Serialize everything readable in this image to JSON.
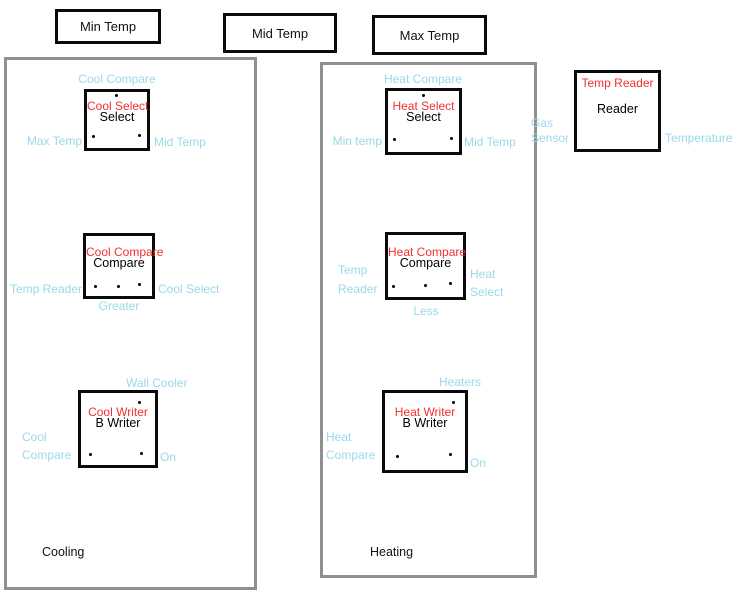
{
  "colors": {
    "port_label_blue": "#99d9ea",
    "block_name_red": "#f23030",
    "panel_border_gray": "#8f8f8f",
    "block_border_black": "#0a0a0a"
  },
  "variables": [
    {
      "label": "Min Temp"
    },
    {
      "label": "Mid Temp"
    },
    {
      "label": "Max Temp"
    }
  ],
  "groups": [
    {
      "label": "Cooling"
    },
    {
      "label": "Heating"
    }
  ],
  "blocks": [
    {
      "red_label": "Cool Select",
      "type_label": "Select",
      "top_label": "Cool Compare",
      "left_label": "Max Temp",
      "right_label": "Mid Temp"
    },
    {
      "red_label": "Cool Compare",
      "type_label": "Compare",
      "left_label": "Temp Reader",
      "right_label": "Cool Select",
      "bottom_label": "Greater"
    },
    {
      "red_label": "Cool Writer",
      "type_label": "B Writer",
      "top_label": "Wall Cooler",
      "left_label": "Cool Compare",
      "right_label": "On"
    },
    {
      "red_label": "Heat Select",
      "type_label": "Select",
      "top_label": "Heat Compare",
      "left_label": "Min temp",
      "right_label": "Mid Temp"
    },
    {
      "red_label": "Heat Compare",
      "type_label": "Compare",
      "left_label": "Temp Reader",
      "right_label": "Heat Select",
      "bottom_label": "Less"
    },
    {
      "red_label": "Heat Writer",
      "type_label": "B Writer",
      "top_label": "Heaters",
      "left_label": "Heat Compare",
      "right_label": "On"
    },
    {
      "red_label": "Temp Reader",
      "type_label": "Reader",
      "left_label": "Gas Sensor",
      "right_label": "Temperature"
    }
  ]
}
